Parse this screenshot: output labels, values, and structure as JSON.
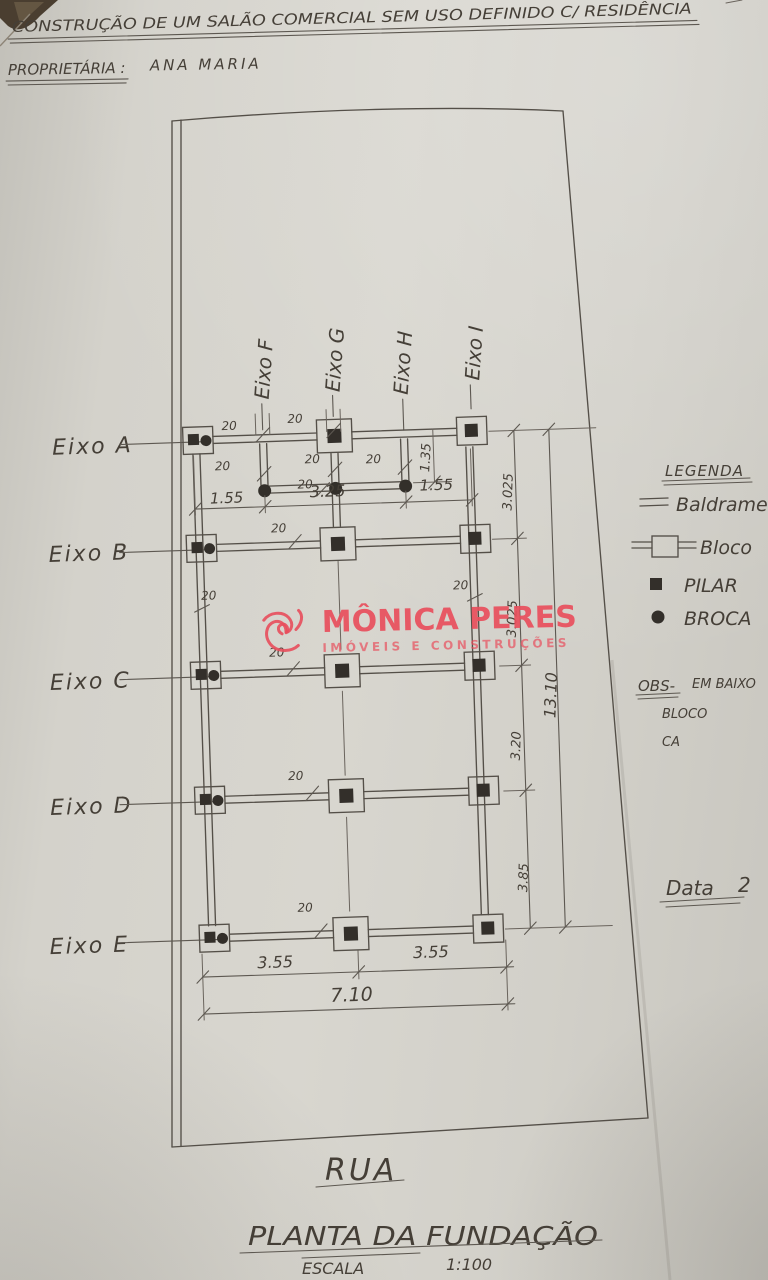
{
  "header": {
    "title": "CONSTRUÇÃO DE UM SALÃO COMERCIAL SEM USO DEFINIDO C/ RESIDÊNCIA",
    "owner_label": "PROPRIETÁRIA :",
    "owner_name": "ANA MARIA"
  },
  "watermark": {
    "brand": "MÔNICA PERES",
    "tagline": "IMÓVEIS E CONSTRUÇÕES",
    "color": "#e84e5c"
  },
  "axes": {
    "rows": [
      "Eixo A",
      "Eixo B",
      "Eixo C",
      "Eixo D",
      "Eixo E"
    ],
    "cols": [
      "Eixo F",
      "Eixo G",
      "Eixo H",
      "Eixo I"
    ]
  },
  "dims": {
    "wall": "20",
    "top": [
      "1.55",
      "3.25",
      "1.55"
    ],
    "broca_drop": "1.35",
    "right": [
      "3.025",
      "3.025",
      "3.20",
      "3.85"
    ],
    "right_total": "13.10",
    "bottom": [
      "3.55",
      "3.55"
    ],
    "bottom_total": "7.10"
  },
  "legend": {
    "title": "LEGENDA",
    "items": [
      "Baldrame",
      "Bloco",
      "PILAR",
      "BROCA"
    ]
  },
  "obs": {
    "label": "OBS-",
    "line1": "EM BAIXO",
    "line2": "BLOCO",
    "line3": "CA"
  },
  "footer": {
    "date_label": "Data",
    "date_value": "2",
    "street": "RUA",
    "title": "PLANTA DA FUNDAÇÃO",
    "scale_label": "ESCALA",
    "scale_value": "1:100"
  },
  "colors": {
    "ink": "#4e4a44",
    "paper": "#d3d1ca",
    "watermark_red": "#e84e5c"
  }
}
